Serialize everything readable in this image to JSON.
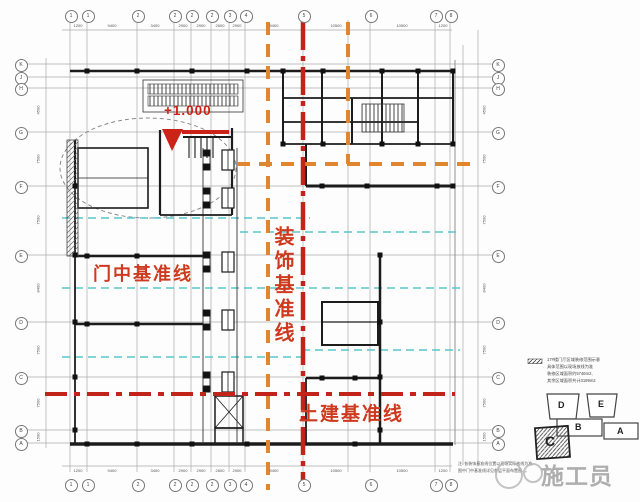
{
  "colors": {
    "label_red": "#ce3a1e",
    "line_red": "#c2231a",
    "deco_orange": "#e0862e",
    "cyan_datum": "#58c6cc",
    "wall_black": "#1c1c1c",
    "grid_gray": "#a5a5a5",
    "watermark_gray": "#9b9b9b"
  },
  "elevation": {
    "label": "+1.000"
  },
  "datum_labels": {
    "door": "门中基准线",
    "decoration": "装饰基准线",
    "civil": "土建基准线"
  },
  "grid": {
    "top_bubbles": [
      {
        "x": 70,
        "label": "1"
      },
      {
        "x": 87,
        "label": "1"
      },
      {
        "x": 137,
        "label": "2"
      },
      {
        "x": 174,
        "label": "2"
      },
      {
        "x": 191,
        "label": "2"
      },
      {
        "x": 211,
        "label": "2"
      },
      {
        "x": 229,
        "label": "3"
      },
      {
        "x": 245,
        "label": "4"
      },
      {
        "x": 303,
        "label": "5"
      },
      {
        "x": 370,
        "label": "6"
      },
      {
        "x": 435,
        "label": "7"
      },
      {
        "x": 450,
        "label": "8"
      }
    ],
    "bottom_bubbles": [
      {
        "x": 70,
        "label": "1"
      },
      {
        "x": 87,
        "label": "1"
      },
      {
        "x": 137,
        "label": "2"
      },
      {
        "x": 174,
        "label": "2"
      },
      {
        "x": 191,
        "label": "2"
      },
      {
        "x": 211,
        "label": "2"
      },
      {
        "x": 229,
        "label": "3"
      },
      {
        "x": 245,
        "label": "4"
      },
      {
        "x": 303,
        "label": "5"
      },
      {
        "x": 370,
        "label": "6"
      },
      {
        "x": 435,
        "label": "7"
      },
      {
        "x": 450,
        "label": "8"
      }
    ],
    "left_bubbles": [
      {
        "y": 64,
        "label": "K"
      },
      {
        "y": 77,
        "label": "J"
      },
      {
        "y": 88,
        "label": "H"
      },
      {
        "y": 132,
        "label": "G"
      },
      {
        "y": 186,
        "label": "F"
      },
      {
        "y": 255,
        "label": "E"
      },
      {
        "y": 322,
        "label": "D"
      },
      {
        "y": 377,
        "label": "C"
      },
      {
        "y": 430,
        "label": "B"
      },
      {
        "y": 443,
        "label": "A"
      }
    ],
    "right_bubbles": [
      {
        "y": 64,
        "label": "K"
      },
      {
        "y": 77,
        "label": "J"
      },
      {
        "y": 88,
        "label": "H"
      },
      {
        "y": 132,
        "label": "G"
      },
      {
        "y": 186,
        "label": "F"
      },
      {
        "y": 255,
        "label": "E"
      },
      {
        "y": 322,
        "label": "D"
      },
      {
        "y": 377,
        "label": "C"
      },
      {
        "y": 430,
        "label": "B"
      },
      {
        "y": 443,
        "label": "A"
      }
    ],
    "top_dims": [
      {
        "x": 78,
        "text": "1200"
      },
      {
        "x": 112,
        "text": "9400"
      },
      {
        "x": 155,
        "text": "3400"
      },
      {
        "x": 183,
        "text": "2900"
      },
      {
        "x": 201,
        "text": "2900"
      },
      {
        "x": 220,
        "text": "2600"
      },
      {
        "x": 237,
        "text": "2900"
      },
      {
        "x": 274,
        "text": "9400"
      },
      {
        "x": 336,
        "text": "10500"
      },
      {
        "x": 402,
        "text": "10500"
      },
      {
        "x": 443,
        "text": "1200"
      }
    ],
    "bottom_dims": [
      {
        "x": 78,
        "text": "1200"
      },
      {
        "x": 112,
        "text": "9400"
      },
      {
        "x": 155,
        "text": "3400"
      },
      {
        "x": 183,
        "text": "2900"
      },
      {
        "x": 201,
        "text": "2900"
      },
      {
        "x": 220,
        "text": "2600"
      },
      {
        "x": 237,
        "text": "2900"
      },
      {
        "x": 274,
        "text": "9400"
      },
      {
        "x": 336,
        "text": "10500"
      },
      {
        "x": 402,
        "text": "10500"
      },
      {
        "x": 443,
        "text": "1200"
      }
    ],
    "left_dims": [
      {
        "y": 110,
        "text": "4500"
      },
      {
        "y": 159,
        "text": "7500"
      },
      {
        "y": 220,
        "text": "7500"
      },
      {
        "y": 288,
        "text": "8400"
      },
      {
        "y": 350,
        "text": "7500"
      },
      {
        "y": 403,
        "text": "7500"
      },
      {
        "y": 437,
        "text": "1500"
      }
    ],
    "right_dims": [
      {
        "y": 110,
        "text": "4500"
      },
      {
        "y": 159,
        "text": "7500"
      },
      {
        "y": 220,
        "text": "7500"
      },
      {
        "y": 288,
        "text": "8400"
      },
      {
        "y": 350,
        "text": "7500"
      },
      {
        "y": 403,
        "text": "7500"
      },
      {
        "y": 437,
        "text": "1500"
      }
    ]
  },
  "key_plan": {
    "legend_lines": [
      "17#楼门厅区域装修范围示意",
      "具体范围以现场放线为准",
      "装修区域面积约5746m2,",
      "其余区域面积共计3199m2"
    ],
    "blocks": [
      "D",
      "E",
      "B",
      "A",
      "C"
    ]
  },
  "notes": [
    "注: 各装饰基准线位置以现场实际放线为准,",
    "图中门中基准线详见各层平面布置图"
  ],
  "watermark": {
    "text": "施工员"
  }
}
